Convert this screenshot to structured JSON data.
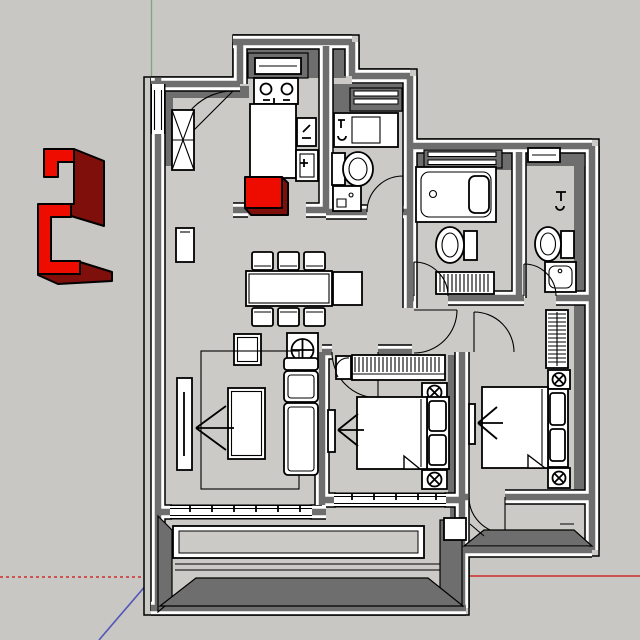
{
  "viewport": {
    "app_context": "3d-modeling-viewport",
    "view": "top-down-floor-plan",
    "visible_text": []
  },
  "colors": {
    "bg": "#c8c7c3",
    "floor": "#cccac6",
    "wall": "#6e6e6e",
    "wall_dark": "#585858",
    "white": "#ffffff",
    "outline": "#000000",
    "select_red": "#ee0b00",
    "select_red_dark": "#7e0f0b",
    "axis_red": "#cc2f2a",
    "axis_green": "#7fa77f",
    "axis_blue": "#5256b8"
  },
  "axes": {
    "green_axis": "solid-up",
    "red_axis_positive": "solid-right",
    "red_axis_negative": "dotted-left",
    "blue_axis": "solid-lower-left-with-dotted-continuation"
  },
  "components": {
    "selected_component": "red-extruded-2-shape",
    "selected_box": "red-cube-in-kitchen",
    "rooms": [
      "entry",
      "kitchen",
      "bath-a",
      "bath-b",
      "bath-c",
      "living-dining",
      "bedroom-1",
      "bedroom-2",
      "balcony-1",
      "balcony-2"
    ],
    "furniture": [
      "stove",
      "range-hood",
      "kitchen-counter",
      "cutting-board",
      "kitchen-sink",
      "shoe-cabinet",
      "wall-panel",
      "dining-table",
      "dining-chairs",
      "side-table",
      "fan-table",
      "rug",
      "coffee-table",
      "sofa",
      "tv-living",
      "bathtub",
      "toilets",
      "sinks",
      "towel-radiator",
      "wardrobe",
      "beds",
      "nightstands",
      "radiator",
      "balcony-railing"
    ]
  }
}
